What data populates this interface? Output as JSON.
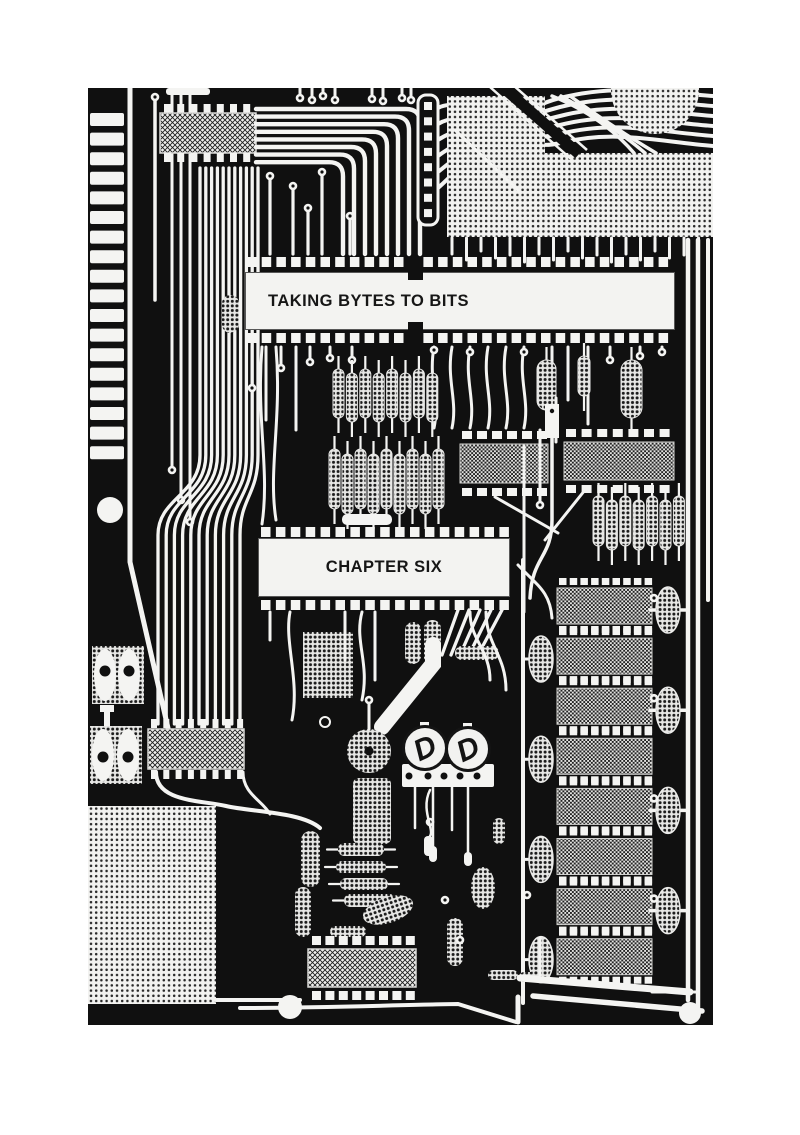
{
  "page": {
    "background_color": "#ffffff"
  },
  "artwork": {
    "type": "halftone-photograph",
    "subject": "printed-circuit-board",
    "colors": {
      "board": "#101010",
      "traces": "#f4f4f2",
      "label_box": "#f3f3f1",
      "label_text": "#161616"
    }
  },
  "labels": {
    "heading": "TAKING BYTES TO BITS",
    "chapter": "CHAPTER SIX"
  }
}
